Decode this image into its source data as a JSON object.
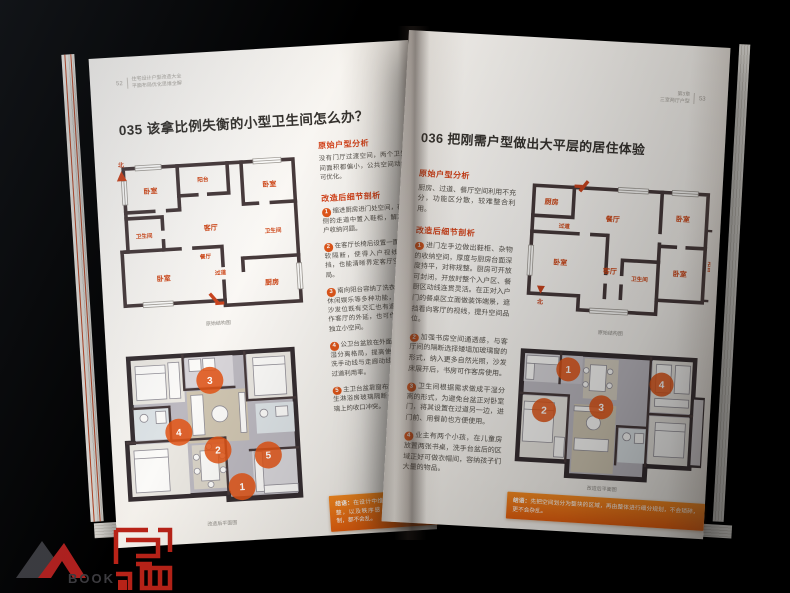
{
  "accent_orange": "#e2571a",
  "left_page": {
    "page_number": "52",
    "running_head_line1": "住宅设计户型改造大全",
    "running_head_line2": "平面布局优化思维全解",
    "title": "035 该拿比例失衡的小型卫生间怎么办？",
    "plan_original": {
      "caption": "原始结构图",
      "north_label": "北",
      "rooms": [
        "卧室",
        "阳台",
        "卧室",
        "客厅",
        "卫生间",
        "卫生间",
        "卧室",
        "餐厅",
        "过道",
        "厨房"
      ]
    },
    "analysis_heading": "原始户型分析",
    "analysis_text": "没有门厅过渡空间，两个卫生间面积都偏小，公共空间动线可优化。",
    "detail_heading": "改造后细节剖析",
    "items": [
      {
        "num": "1",
        "text": "缩进厨房进门处空间，在右侧的走道中置入鞋柜，解决入户收纳问题。"
      },
      {
        "num": "2",
        "text": "在客厅长椅后设置一面墙或软隔断，使得入户视线有遮挡，也能清晰界定客厅空间布局。"
      },
      {
        "num": "3",
        "text": "南向阳台容纳了洗衣干衣、休闲娱乐等多种功能，视线与沙发位既有交汇也有遮挡，可作客厅的外延，也可作为一个独立小空间。"
      },
      {
        "num": "4",
        "text": "公卫台盆放在外面，形成干湿分离格局，提高使用效率，洗手动线与走廊动线结合提高过道利用率。"
      },
      {
        "num": "5",
        "text": "主卫台盆靠窗布置，避免产生淋浴房玻璃隔断卡在窗户玻璃上的收口冲突。"
      }
    ],
    "plan_renovated": {
      "caption": "改造后平面图",
      "markers": [
        "1",
        "2",
        "3",
        "4",
        "5"
      ]
    },
    "conclusion_label": "结语：",
    "conclusion_text": "在设计中维持空间的整齐、完整，以及秩序感，不论受到何种限制，都不会乱。"
  },
  "right_page": {
    "page_number": "53",
    "running_head_line1": "第3章",
    "running_head_line2": "三室两厅户型",
    "title": "036 把刚需户型做出大平层的居住体验",
    "analysis_heading": "原始户型分析",
    "analysis_text": "厨房、过道、餐厅空间利用不充分，功能区分散，较难整合利用。",
    "detail_heading": "改造后细节剖析",
    "items": [
      {
        "num": "1",
        "text": "进门左手边做出鞋柜、杂物的收纳空间，厚度与厨房台面深度持平，对称规整。厨房可开放可封闭，开放时整个入户区、餐厨区动线连贯灵活。在正对入户门的餐桌区立面做装饰端景，遮挡看向客厅的视线，提升空间品位。"
      },
      {
        "num": "2",
        "text": "加强书房空间通透感，与客厅间的隔断选择矮墙加玻璃窗的形式，纳入更多自然光照，沙发床展开后，书房可作客房使用。"
      },
      {
        "num": "3",
        "text": "卫生间根据需求做成干湿分离的形式，为避免台盆正对卧室门，将其设置在过道另一边，进门前、用餐前也方便使用。"
      },
      {
        "num": "4",
        "text": "业主有两个小孩，在儿童房放置两张书桌，洗手台盆后的区域正好可做衣帽间，容纳孩子们大量的物品。"
      }
    ],
    "plan_original": {
      "caption": "原始结构图",
      "north_label": "北",
      "rooms": [
        "厨房",
        "过道",
        "餐厅",
        "卧室",
        "卧室",
        "客厅",
        "卫生间",
        "卧室",
        "阳台"
      ]
    },
    "plan_renovated": {
      "caption": "改造后平面图",
      "markers": [
        "1",
        "2",
        "3",
        "4"
      ]
    },
    "conclusion_label": "结语：",
    "conclusion_text": "先把空间划分为整块的区域，再由整体进行细分规划，不会琐碎，更不会杂乱。"
  },
  "watermark": {
    "logo_text": "BOOK"
  }
}
